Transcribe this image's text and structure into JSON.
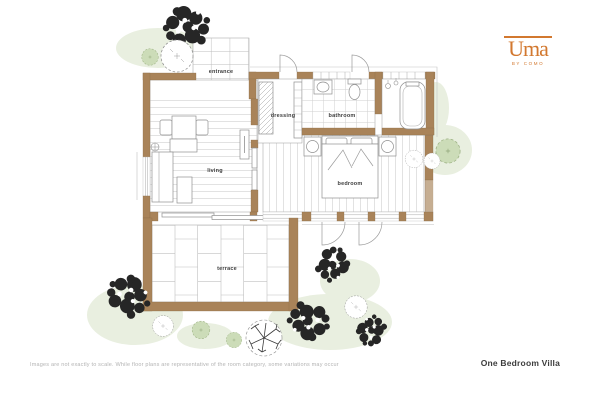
{
  "logo": {
    "name": "Uma",
    "tagline": "BY COMO"
  },
  "rooms": {
    "entrance": "entrance",
    "dressing": "dressing",
    "bathroom": "bathroom",
    "living": "living",
    "bedroom": "bedroom",
    "terrace": "terrace"
  },
  "footer": {
    "disclaimer": "Images are not exactly to scale. While floor plans are representative of the room category, some variations may occur",
    "plan_title": "One Bedroom Villa"
  },
  "colors": {
    "wall": "#a98359",
    "accent": "#d2782f",
    "bush": "#ccdcb8",
    "wash": "#e9efe0",
    "line": "#9a9a9a",
    "text": "#3c3c3c",
    "muted": "#b3b3b3"
  }
}
